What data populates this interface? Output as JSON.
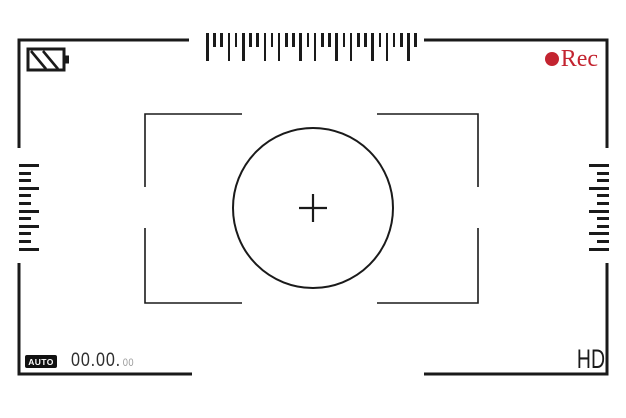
{
  "viewfinder": {
    "rec": {
      "label": "Rec",
      "color": "#c32430"
    },
    "battery": {
      "level": "charged-striped"
    },
    "footer": {
      "auto_label": "AUTO",
      "timecode_main": "00.00.",
      "timecode_frames": "00",
      "hd_label": "HD"
    },
    "colors": {
      "line": "#1a1a1a",
      "accent_red": "#c32430",
      "muted_gray": "#9a9a9a"
    },
    "rulers": {
      "top": {
        "pattern": [
          "long",
          "short",
          "short",
          "long",
          "short",
          "long",
          "short",
          "short",
          "long",
          "short",
          "long",
          "short",
          "short",
          "long",
          "short",
          "long",
          "short",
          "short",
          "long",
          "short",
          "long",
          "short",
          "short",
          "long",
          "short",
          "long",
          "short",
          "short",
          "long",
          "short"
        ]
      },
      "left": {
        "pattern": [
          "long",
          "short",
          "short",
          "long",
          "short",
          "short",
          "long",
          "short",
          "long",
          "short",
          "short",
          "long"
        ]
      },
      "right": {
        "pattern": [
          "long",
          "short",
          "short",
          "long",
          "short",
          "short",
          "long",
          "short",
          "short",
          "long",
          "short",
          "long"
        ]
      }
    }
  }
}
